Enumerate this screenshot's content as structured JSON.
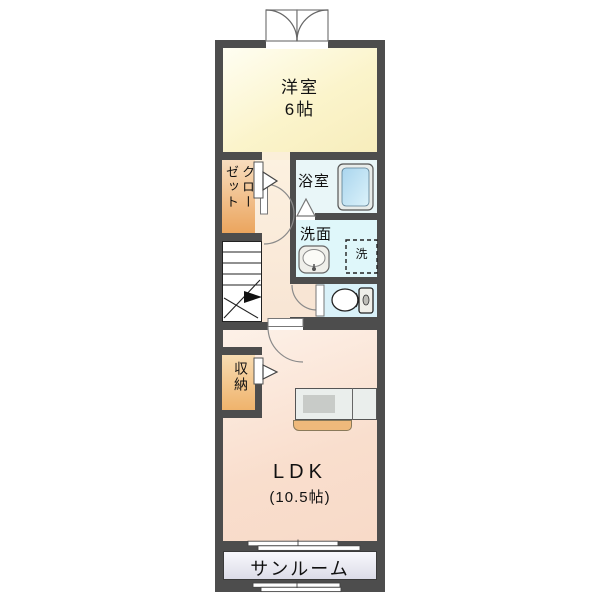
{
  "rooms": {
    "western_room": {
      "name_line": "洋室",
      "size_line": "6帖"
    },
    "closet": {
      "full": "クローゼット",
      "column1": "クロー",
      "column2": "ゼット"
    },
    "bath": {
      "label": "浴室"
    },
    "washroom": {
      "label": "洗面"
    },
    "washer_space": {
      "label": "洗"
    },
    "storage": {
      "label": "収納"
    },
    "ldk": {
      "name_line": "LDK",
      "size_line": "(10.5帖)"
    },
    "sunroom": {
      "label": "サンルーム"
    }
  },
  "colors": {
    "wall": "#4D4D4D",
    "western_room": "#FBF4CB",
    "hall": "#F8E5D4",
    "closet": "#EBA55E",
    "bath": "#E9F6F8",
    "washroom": "#DFF7FA",
    "toilet": "#D9F1F9",
    "ldk": "#F9DECD",
    "sunroom": "#E3E3EE",
    "kitchen_counter": "#EAEEEC",
    "kitchen_base": "#EFB97B",
    "bathtub": "#BCE0F2"
  }
}
